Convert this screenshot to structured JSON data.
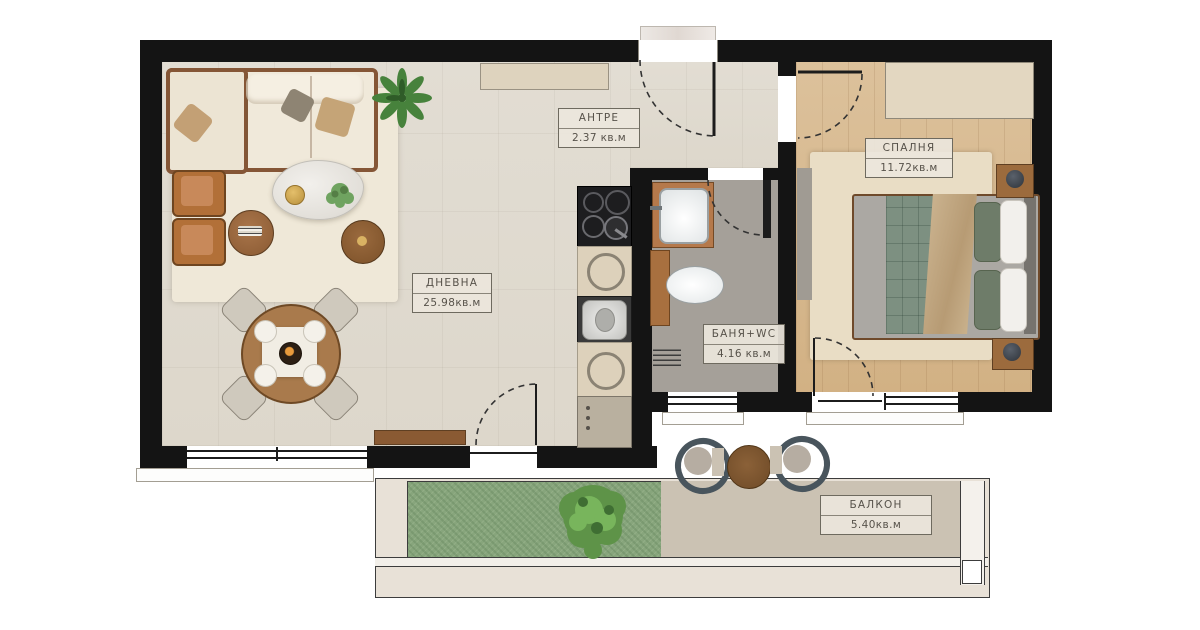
{
  "plan_type": "apartment-floor-plan",
  "rooms": {
    "antre": {
      "name": "АНТРЕ",
      "area": "2.37 кв.м"
    },
    "living": {
      "name": "ДНЕВНА",
      "area": "25.98кв.м"
    },
    "bath": {
      "name": "БАНЯ+WC",
      "area": "4.16 кв.м"
    },
    "bedroom": {
      "name": "СПАЛНЯ",
      "area": "11.72кв.м"
    },
    "balcony": {
      "name": "БАЛКОН",
      "area": "5.40кв.м"
    }
  },
  "palette": {
    "wall": "#141414",
    "tile_floor": "#e0dbd0",
    "wood_floor": "#d8bb92",
    "bath_floor": "#a5a099",
    "balcony_floor": "#cbc2b3",
    "terrace": "#e8e1d7",
    "grass": "#87a57c",
    "label_text": "#57524a",
    "furniture_wood": "#9c6b3d"
  },
  "furniture_icons": {
    "sofa-icon": "l-shaped sofa",
    "armchair-icon": "leather armchair",
    "coffee-table-icon": "oval marble table",
    "dining-table-icon": "round table with 4 chairs",
    "cooktop-icon": "4-burner hob",
    "kitchen-sink-icon": "steel sink",
    "vanity-sink-icon": "bathroom washbasin",
    "toilet-icon": "wc bowl",
    "bed-icon": "double bed",
    "wardrobe-icon": "closet",
    "plant-icon": "potted plant",
    "bush-icon": "garden shrub",
    "balcony-set-icon": "two chairs and table"
  }
}
